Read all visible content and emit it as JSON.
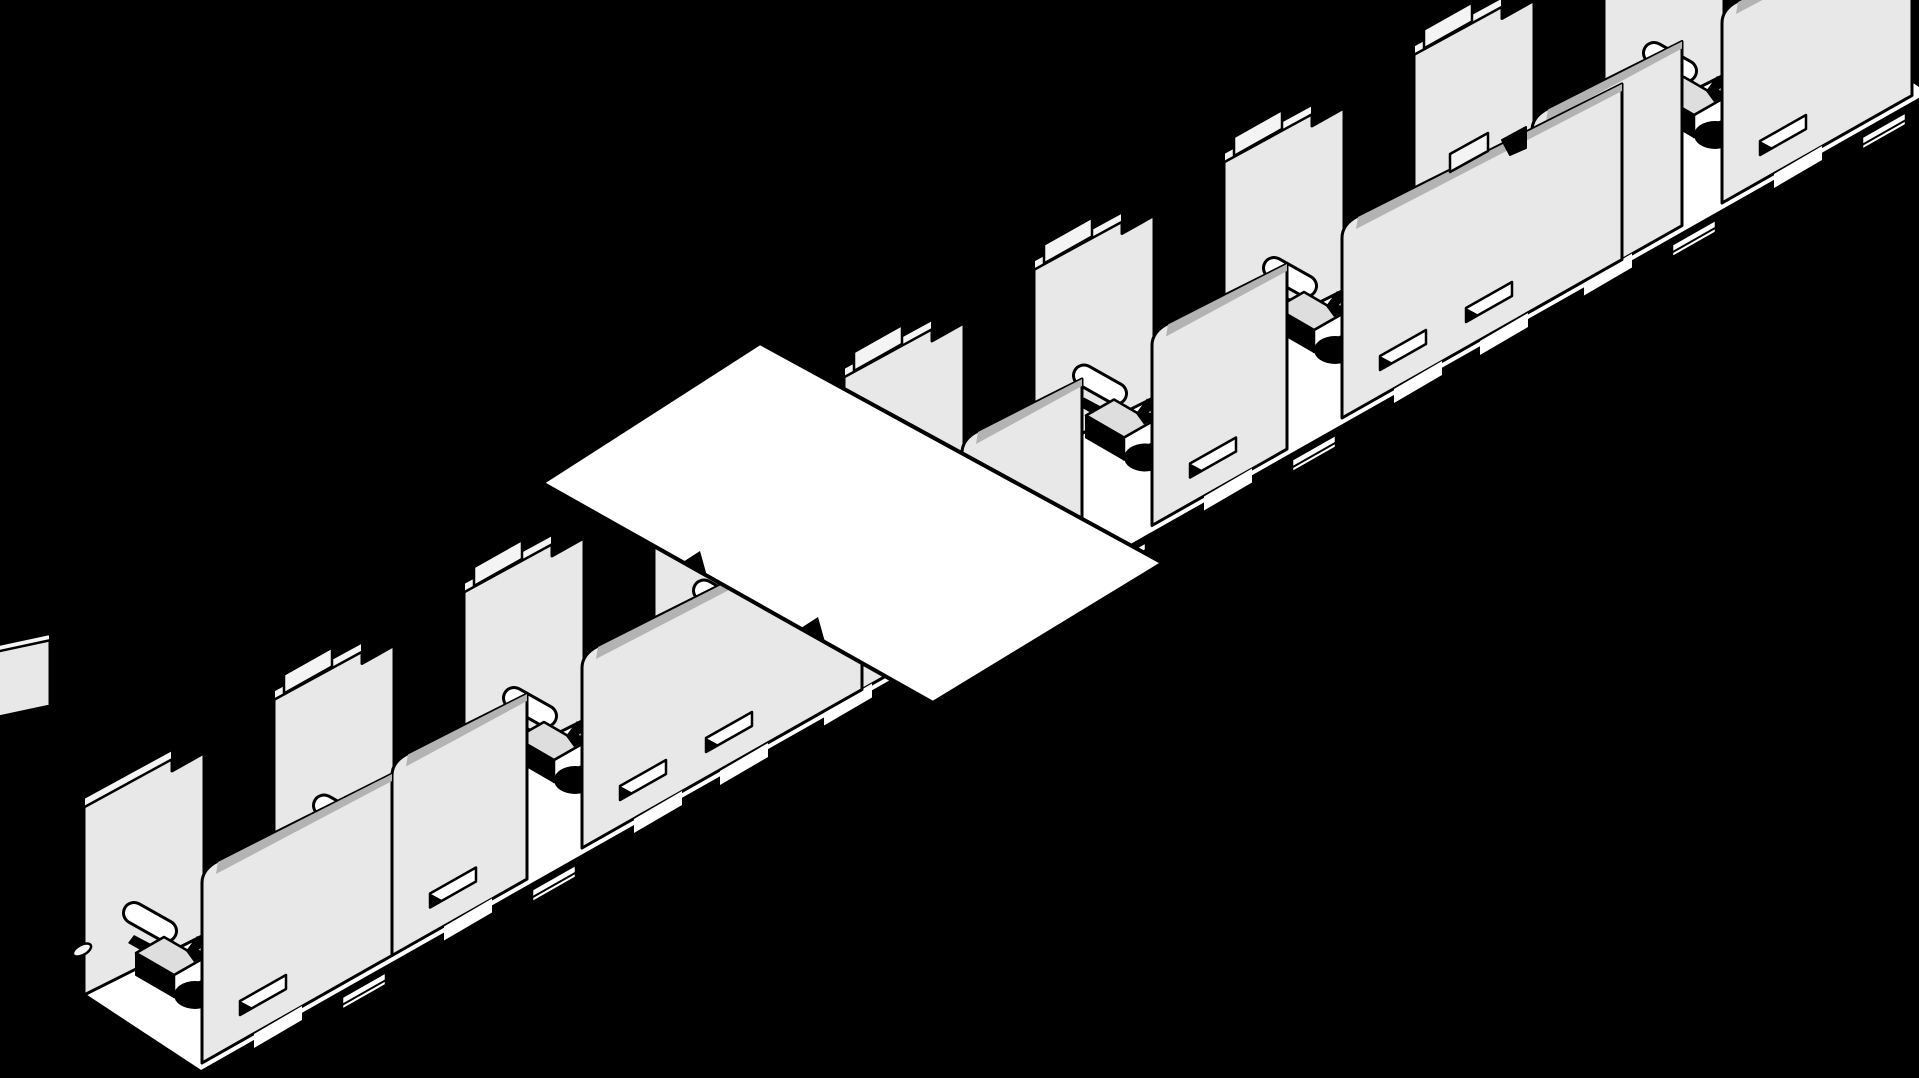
{
  "canvas": {
    "width": 1919,
    "height": 1078,
    "background": "#000000"
  },
  "colors": {
    "background": "#000000",
    "panel": "#e8e8e8",
    "panel_light": "#f4f4f4",
    "bevel_dark": "#b3b3b3",
    "white": "#ffffff",
    "box_top": "#dedede",
    "outline": "#000000"
  },
  "strokes": {
    "panel": 3,
    "detail": 2.5,
    "roof": 4,
    "floor": 3.5
  },
  "slopes": {
    "band": 0.5658,
    "panel_top": 0.5,
    "divider_top": 0.55
  },
  "floor_base": {
    "points": [
      [
        84,
        995
      ],
      [
        1816,
        15
      ],
      [
        1931,
        93
      ],
      [
        201,
        1072
      ]
    ]
  },
  "roof_panel": {
    "points": [
      [
        760,
        343
      ],
      [
        1163,
        563
      ],
      [
        933,
        703
      ],
      [
        542,
        483
      ]
    ],
    "notches": [
      [
        [
          683,
          562
        ],
        [
          707,
          576
        ],
        [
          700,
          551
        ]
      ],
      [
        [
          801,
          628
        ],
        [
          825,
          642
        ],
        [
          818,
          617
        ]
      ]
    ]
  },
  "edge_fragment": {
    "face": [
      [
        -6,
        718
      ],
      [
        -6,
        652
      ],
      [
        50,
        640
      ],
      [
        50,
        706
      ]
    ],
    "bevel": [
      [
        -6,
        652
      ],
      [
        -6,
        646
      ],
      [
        50,
        634
      ],
      [
        50,
        640
      ]
    ]
  },
  "modules": [
    {
      "id": 1,
      "ex": 190,
      "ey": 997,
      "divider_tab": false,
      "partition_width": 190,
      "second_slot": false,
      "top_notch": false,
      "partition_tab": false
    },
    {
      "id": 2,
      "ex": 380,
      "ey": 889.5,
      "divider_tab": true,
      "partition_width": 135,
      "second_slot": false,
      "top_notch": false,
      "partition_tab": false
    },
    {
      "id": 3,
      "ex": 570,
      "ey": 782,
      "divider_tab": true,
      "partition_width": 280,
      "second_slot": true,
      "top_notch": false,
      "partition_tab": false
    },
    {
      "id": 4,
      "ex": 760,
      "ey": 674.5,
      "divider_tab": true,
      "partition_width": 135,
      "second_slot": false,
      "top_notch": false,
      "partition_tab": false
    },
    {
      "id": 5,
      "ex": 950,
      "ey": 567,
      "divider_tab": true,
      "partition_width": 120,
      "second_slot": false,
      "top_notch": false,
      "partition_tab": false
    },
    {
      "id": 6,
      "ex": 1140,
      "ey": 459.5,
      "divider_tab": true,
      "partition_width": 135,
      "second_slot": false,
      "top_notch": false,
      "partition_tab": false
    },
    {
      "id": 7,
      "ex": 1330,
      "ey": 352,
      "divider_tab": true,
      "partition_width": 280,
      "second_slot": true,
      "top_notch": true,
      "partition_tab": true
    },
    {
      "id": 8,
      "ex": 1520,
      "ey": 244.5,
      "divider_tab": true,
      "partition_width": 150,
      "second_slot": false,
      "top_notch": false,
      "partition_tab": false
    },
    {
      "id": 9,
      "ex": 1710,
      "ey": 137,
      "divider_tab": true,
      "partition_width": 190,
      "second_slot": false,
      "top_notch": false,
      "partition_tab": false
    }
  ]
}
